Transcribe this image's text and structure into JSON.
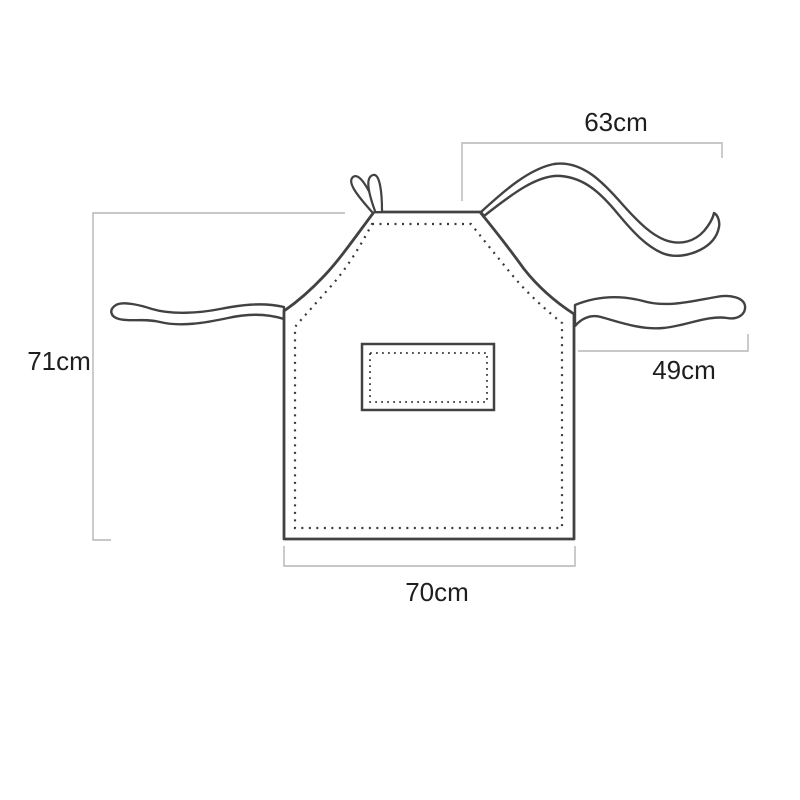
{
  "diagram": {
    "name": "apron-size-diagram",
    "colors": {
      "background": "#ffffff",
      "outline": "#424242",
      "stitch": "#3a3a3a",
      "dimension_line": "#b5b5b5",
      "label_text": "#1e1e1e"
    },
    "dimensions": {
      "neck_strap": {
        "label": "63cm",
        "position": "top-right"
      },
      "height": {
        "label": "71cm",
        "position": "left"
      },
      "waist_tie": {
        "label": "49cm",
        "position": "right"
      },
      "width": {
        "label": "70cm",
        "position": "bottom"
      }
    }
  }
}
